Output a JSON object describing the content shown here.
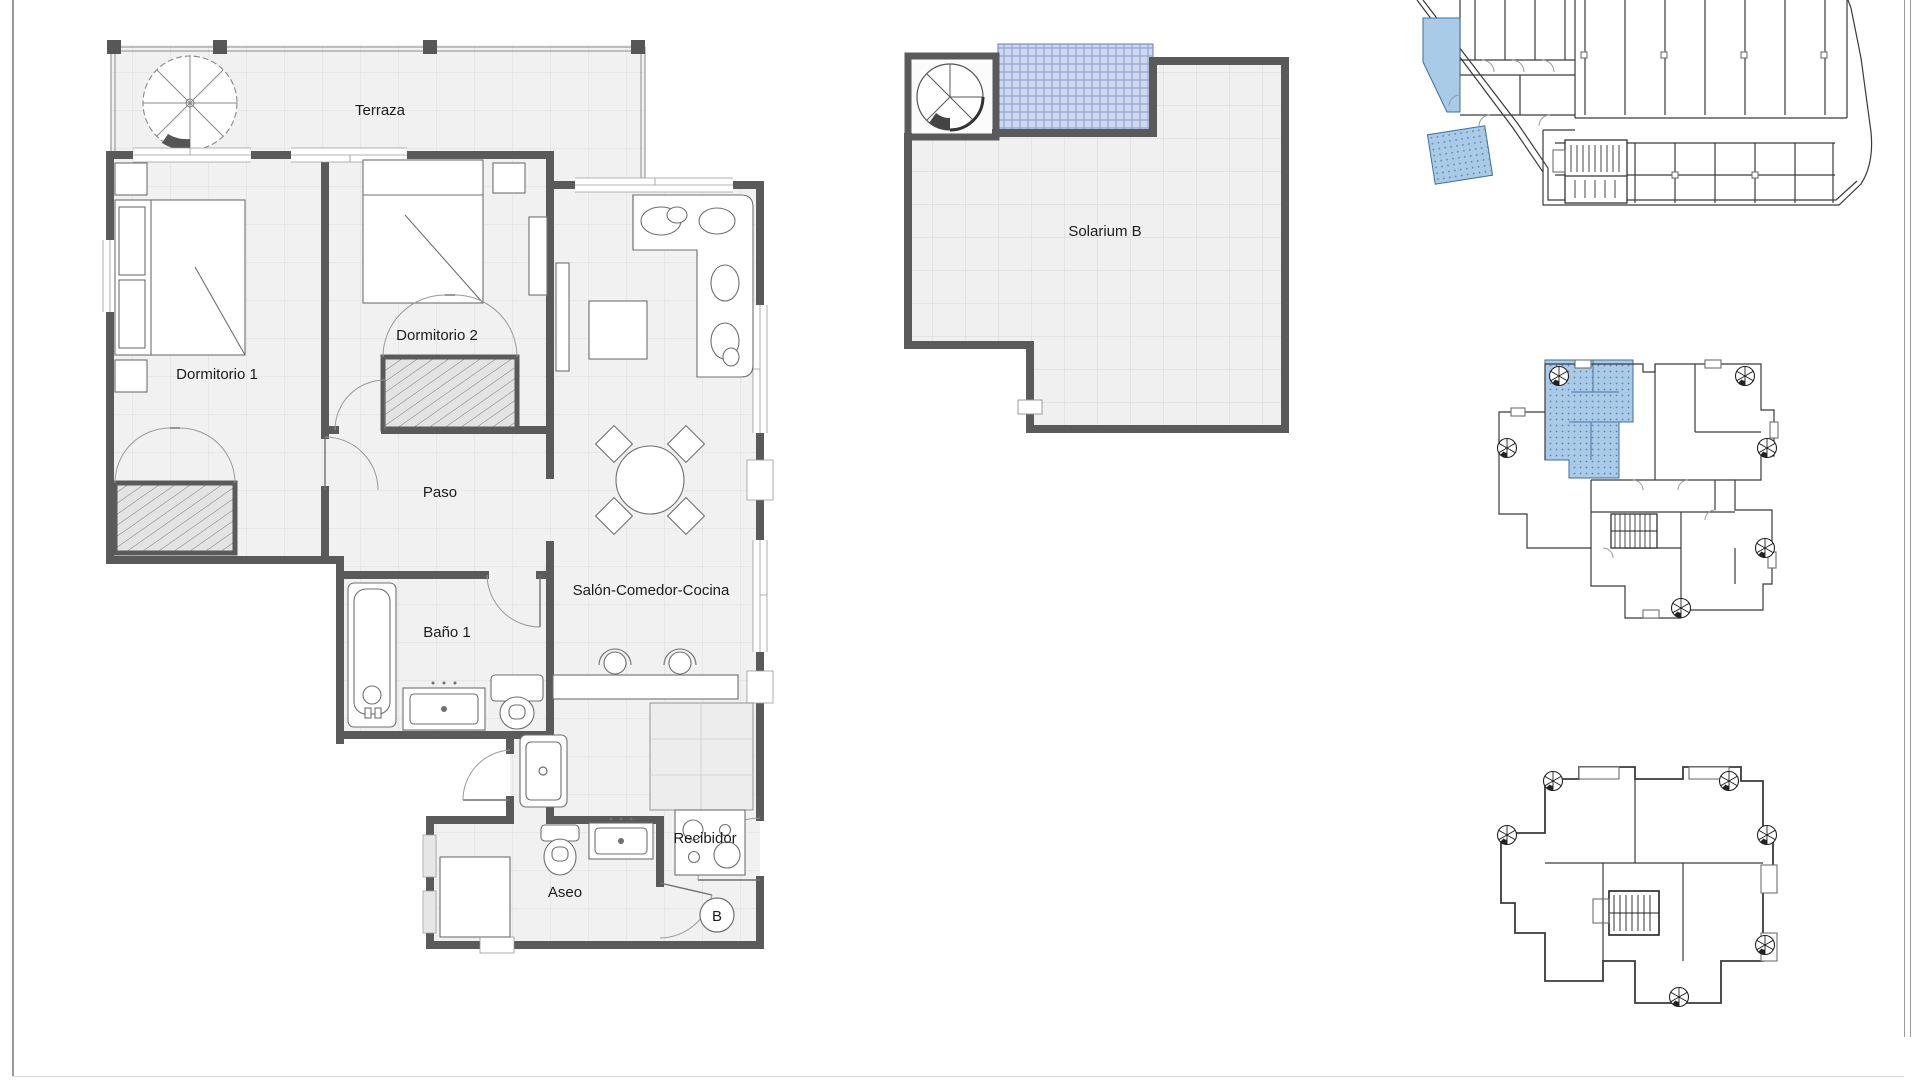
{
  "page": {
    "background": "#ffffff",
    "border_color": "#9a9a9a"
  },
  "main_plan": {
    "labels": {
      "terraza": "Terraza",
      "dormitorio1": "Dormitorio 1",
      "dormitorio2": "Dormitorio 2",
      "paso": "Paso",
      "bano1": "Baño 1",
      "salon": "Salón-Comedor-Cocina",
      "aseo": "Aseo",
      "recibidor": "Recibidor"
    },
    "unit_marker": "B"
  },
  "solarium_plan": {
    "label": "Solarium B"
  },
  "colors": {
    "wall": "#5a5a5a",
    "floor": "#f1f1f1",
    "floor_grid": "#dddddd",
    "thin_line": "#333333",
    "unit_highlight": "#a9cbe8",
    "unit_highlight_border": "#3d6e9e",
    "pergola_fill": "#cdd7f0",
    "pergola_grid": "#8a9ac8"
  }
}
